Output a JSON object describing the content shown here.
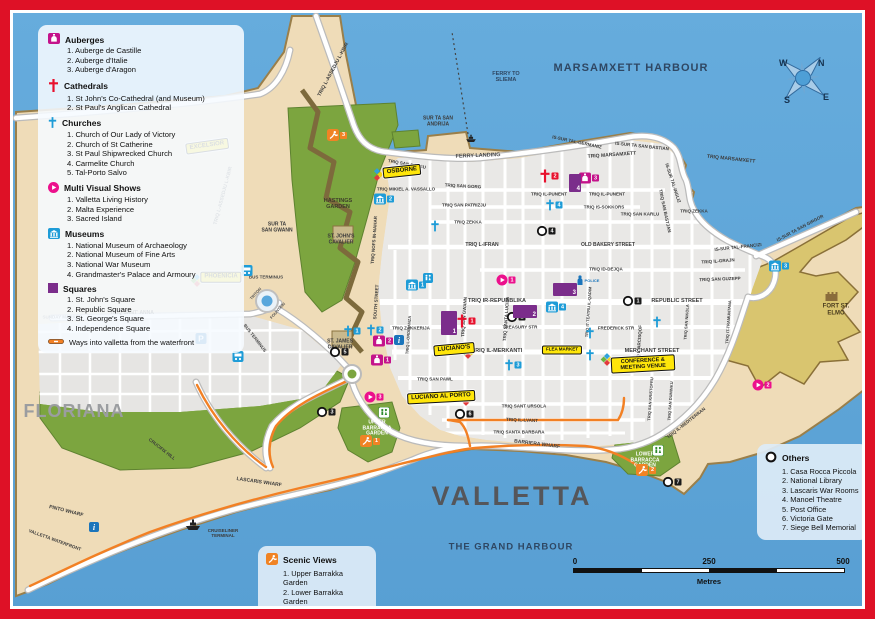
{
  "labels": {
    "city": "VALLETTA",
    "district": "FLORIANA",
    "harbour_top": "MARSAMXETT HARBOUR",
    "harbour_bottom": "THE GRAND HARBOUR",
    "fort": "FORT ST. ELMO"
  },
  "legend_main": {
    "sections": [
      {
        "key": "auberge",
        "title": "Auberges",
        "icon": "auberge-icon",
        "color": "#C4138B",
        "items": [
          "Auberge de Castille",
          "Auberge d'Italie",
          "Auberge d'Aragon"
        ]
      },
      {
        "key": "cathedral",
        "title": "Cathedrals",
        "icon": "cathedral-cross-icon",
        "color": "#E8112D",
        "items": [
          "St John's Co-Cathedral (and Museum)",
          "St Paul's Anglican Cathedral"
        ]
      },
      {
        "key": "church",
        "title": "Churches",
        "icon": "church-cross-icon",
        "color": "#1E9CD7",
        "items": [
          "Church of Our Lady of Victory",
          "Church of St Catherine",
          "St Paul Shipwrecked Church",
          "Carmelite Church",
          "Tal-Porto Salvo"
        ]
      },
      {
        "key": "show",
        "title": "Multi Visual Shows",
        "icon": "play-icon",
        "color": "#EC108C",
        "items": [
          "Valletta Living History",
          "Malta Experience",
          "Sacred Island"
        ]
      },
      {
        "key": "museum",
        "title": "Museums",
        "icon": "museum-icon",
        "color": "#1E9CD7",
        "items": [
          "National Museum of Archaeology",
          "National Museum of Fine Arts",
          "National War Museum",
          "Grandmaster's Palace and Armoury"
        ]
      },
      {
        "key": "square",
        "title": "Squares",
        "icon": "square-icon",
        "color": "#7B2D8B",
        "items": [
          "St. John's Square",
          "Republic Square",
          "St. George's Square",
          "Independence Square"
        ]
      }
    ],
    "ways_note": "Ways into valletta from the waterfront",
    "ways_color": "#F08324"
  },
  "legend_others": {
    "title": "Others",
    "color": "#1A1A1A",
    "items": [
      "Casa Rocca Piccola",
      "National Library",
      "Lascaris War Rooms",
      "Manoel Theatre",
      "Post Office",
      "Victoria Gate",
      "Siege Bell Memorial"
    ]
  },
  "legend_scenic": {
    "title": "Scenic Views",
    "color": "#F08324",
    "items": [
      "Upper Barrakka Garden",
      "Lower Barrakka Garden",
      "Hastings Garden"
    ]
  },
  "compass": {
    "points": [
      "N",
      "E",
      "S",
      "W"
    ]
  },
  "scale_bar": {
    "ticks": [
      "0",
      "250",
      "500"
    ],
    "unit": "Metres"
  },
  "yellow_labels": [
    {
      "text": "EXCELSIOR",
      "x": 207,
      "y": 146,
      "r": -8
    },
    {
      "text": "OSBORNE",
      "x": 402,
      "y": 171,
      "r": -6
    },
    {
      "text": "PHOENICIA",
      "x": 221,
      "y": 277,
      "r": 0
    },
    {
      "text": "LUCIANO'S",
      "x": 454,
      "y": 349,
      "r": -5
    },
    {
      "text": "LUCIANO AL PORTO",
      "x": 441,
      "y": 397,
      "r": -3
    },
    {
      "text": "CONFERENCE & MEETING VENUE",
      "x": 643,
      "y": 364,
      "r": -3,
      "w": 64,
      "s": 5.5
    },
    {
      "text": "FLEA MARKET",
      "x": 562,
      "y": 350,
      "r": 0,
      "s": 4.5
    }
  ],
  "street_labels": [
    {
      "t": "MARSAMXETT HARBOUR",
      "x": 631,
      "y": 68,
      "s": 11,
      "c": "#2F4763",
      "sp": 1
    },
    {
      "t": "THE GRAND HARBOUR",
      "x": 511,
      "y": 548,
      "s": 9.5,
      "c": "#2F4763",
      "sp": 1
    },
    {
      "t": "VALLETTA",
      "x": 512,
      "y": 496,
      "s": 27,
      "c": "#55565A",
      "sp": 3
    },
    {
      "t": "FLORIANA",
      "x": 74,
      "y": 411,
      "s": 18,
      "c": "#9B9DA0",
      "sp": 1
    },
    {
      "t": "FORT ST. ELMO",
      "x": 836,
      "y": 310,
      "s": 6,
      "c": "#4a3c1e"
    },
    {
      "t": "FERRY TO\nSLIEMA",
      "x": 506,
      "y": 77,
      "s": 5.5,
      "c": "#2F4763"
    },
    {
      "t": "FERRY LANDING",
      "x": 478,
      "y": 156,
      "s": 5.5,
      "c": "#4a4a4a",
      "r": -2
    },
    {
      "t": "SUR TA SAN\nANDRIJA",
      "x": 438,
      "y": 122,
      "s": 5
    },
    {
      "t": "HASTINGS\nGARDEN",
      "x": 338,
      "y": 204,
      "s": 5.5,
      "c": "#3d3d2a"
    },
    {
      "t": "ST. JOHN'S\nCAVALIER",
      "x": 341,
      "y": 240,
      "s": 5
    },
    {
      "t": "SUR TA\nSAN GWANN",
      "x": 277,
      "y": 228,
      "s": 5
    },
    {
      "t": "ST. JAMES\nCAVALIER",
      "x": 340,
      "y": 345,
      "s": 5
    },
    {
      "t": "UPPER\nBARRACCA\nGARDEN",
      "x": 377,
      "y": 429,
      "s": 5,
      "c": "#ffffff"
    },
    {
      "t": "LOWER\nBARRACCA\nGARDEN",
      "x": 645,
      "y": 461,
      "s": 5,
      "c": "#ffffff"
    },
    {
      "t": "TRIQ L-ASSEDJU L-KBIR",
      "x": 334,
      "y": 70,
      "r": -62,
      "s": 5
    },
    {
      "t": "TRIQ L-ASSEDJU L-KBIR",
      "x": 224,
      "y": 196,
      "r": -75,
      "s": 5
    },
    {
      "t": "IS-SUR TAL-GERMANIZ",
      "x": 577,
      "y": 142,
      "r": 12,
      "s": 4.5
    },
    {
      "t": "IS-SUR TA SAN BASTIAN",
      "x": 642,
      "y": 146,
      "r": 6,
      "s": 4.5
    },
    {
      "t": "TRIQ MARSAMXETT",
      "x": 612,
      "y": 156,
      "r": -4,
      "s": 5
    },
    {
      "t": "TRIQ MARSAMXETT",
      "x": 731,
      "y": 160,
      "r": 6,
      "s": 5
    },
    {
      "t": "TRIQ SAN BJAGU",
      "x": 407,
      "y": 164,
      "r": 10,
      "s": 4.5
    },
    {
      "t": "TRIQ MIKIEL A. VASSALLO",
      "x": 406,
      "y": 189,
      "s": 4.5
    },
    {
      "t": "TRIQ SAN GORG",
      "x": 463,
      "y": 186,
      "r": 3,
      "s": 4.5
    },
    {
      "t": "TRIQ SAN PATRIZJU",
      "x": 464,
      "y": 205,
      "s": 4.5
    },
    {
      "t": "TRIQ ZEKKA",
      "x": 468,
      "y": 222,
      "s": 4.5
    },
    {
      "t": "TRIQ ZEKKA",
      "x": 694,
      "y": 211,
      "s": 4.5
    },
    {
      "t": "TRIQ IL-PUNENT",
      "x": 549,
      "y": 194,
      "s": 4.5
    },
    {
      "t": "TRIQ IL-PUNENT",
      "x": 607,
      "y": 194,
      "s": 4.5
    },
    {
      "t": "TRIQ IS-SOKKORS",
      "x": 604,
      "y": 207,
      "s": 4.5
    },
    {
      "t": "TRIQ SAN KARLU",
      "x": 640,
      "y": 214,
      "s": 4.5
    },
    {
      "t": "TRIQ L-IFRAN",
      "x": 482,
      "y": 246,
      "s": 5
    },
    {
      "t": "OLD BAKERY STREET",
      "x": 608,
      "y": 246,
      "s": 5
    },
    {
      "t": "TRIQ ID-DEJQA",
      "x": 606,
      "y": 269,
      "s": 4.5
    },
    {
      "t": "TRIQ IR-REPUBBLIKA",
      "x": 497,
      "y": 301,
      "s": 5.5
    },
    {
      "t": "REPUBLIC STREET",
      "x": 677,
      "y": 301,
      "s": 5.5
    },
    {
      "t": "TRIQ ZAKKERIJA",
      "x": 411,
      "y": 328,
      "s": 4.5
    },
    {
      "t": "TREASURY STR",
      "x": 520,
      "y": 327,
      "s": 4.5
    },
    {
      "t": "FREDERICK STR",
      "x": 616,
      "y": 328,
      "s": 4.5
    },
    {
      "t": "TRIQ IL-MERKANTI",
      "x": 497,
      "y": 351,
      "s": 5.5
    },
    {
      "t": "MERCHANT STREET",
      "x": 652,
      "y": 351,
      "s": 5.5
    },
    {
      "t": "TRIQ SAN PAWL",
      "x": 435,
      "y": 379,
      "s": 4.5
    },
    {
      "t": "TRIQ SANT URSOLA",
      "x": 524,
      "y": 406,
      "s": 4.5
    },
    {
      "t": "TRIQ SANTA BARBARA",
      "x": 519,
      "y": 432,
      "s": 4.5
    },
    {
      "t": "BARRIERA WHARF",
      "x": 537,
      "y": 445,
      "r": 7,
      "s": 5
    },
    {
      "t": "TRIQ SANT' ANNA",
      "x": 132,
      "y": 314,
      "s": 5
    },
    {
      "t": "SUNDAY MARKET",
      "x": 62,
      "y": 317,
      "s": 4.5,
      "c": "#666666"
    },
    {
      "t": "CRUCIFIX HILL",
      "x": 162,
      "y": 449,
      "r": 38,
      "s": 4.5
    },
    {
      "t": "LASCARIS WHARF",
      "x": 259,
      "y": 483,
      "r": 8,
      "s": 5
    },
    {
      "t": "PINTO WHARF",
      "x": 66,
      "y": 512,
      "r": 14,
      "s": 5
    },
    {
      "t": "VALLETTA WATERFRONT",
      "x": 55,
      "y": 540,
      "r": 20,
      "s": 4.5
    },
    {
      "t": "CRUISELINER\nTERMINAL",
      "x": 223,
      "y": 533,
      "s": 4.5
    },
    {
      "t": "IS-SUR TAL-INGLIZ",
      "x": 673,
      "y": 183,
      "r": 72,
      "s": 4.5
    },
    {
      "t": "TRIQ SAN BASTJAN",
      "x": 665,
      "y": 211,
      "r": 78,
      "s": 4.5
    },
    {
      "t": "IS-SUR TA SAN GIRGOR",
      "x": 800,
      "y": 228,
      "r": -28,
      "s": 4.5
    },
    {
      "t": "IS-SUR TAL-FRANCIZI",
      "x": 738,
      "y": 247,
      "r": -6,
      "s": 4.5
    },
    {
      "t": "TRIQ IL-GRAJN",
      "x": 718,
      "y": 261,
      "r": -4,
      "s": 4.5
    },
    {
      "t": "TRIQ SAN GUZEPP",
      "x": 720,
      "y": 279,
      "r": -2,
      "s": 4.5
    },
    {
      "t": "TRIQ IL-LVANT",
      "x": 522,
      "y": 420,
      "r": 2,
      "s": 4.5
    },
    {
      "t": "TRIQ NOFS IN-NAHAR",
      "x": 374,
      "y": 240,
      "r": -86,
      "s": 4.5
    },
    {
      "t": "SOUTH STREET",
      "x": 376,
      "y": 302,
      "r": -86,
      "s": 4.5
    },
    {
      "t": "TRIQ L-ORDINANZA",
      "x": 409,
      "y": 335,
      "r": -86,
      "s": 4
    },
    {
      "t": "TRIQ SAN GWANN",
      "x": 464,
      "y": 317,
      "r": -86,
      "s": 4.5
    },
    {
      "t": "TRIQ SANTA LUCIJA",
      "x": 506,
      "y": 319,
      "r": -86,
      "s": 4.5
    },
    {
      "t": "TRIQ IT-TEATRU IL-QADIM",
      "x": 589,
      "y": 312,
      "r": -86,
      "s": 4
    },
    {
      "t": "TRIQ L-ARCISQOF",
      "x": 639,
      "y": 345,
      "r": -86,
      "s": 4.5
    },
    {
      "t": "TRIQ SAN KRISTOFRU",
      "x": 651,
      "y": 399,
      "r": -86,
      "s": 4
    },
    {
      "t": "TRIQ SAN DUMINKU",
      "x": 671,
      "y": 401,
      "r": -86,
      "s": 4
    },
    {
      "t": "TRIQ SAN NIKOLA",
      "x": 687,
      "y": 322,
      "r": -86,
      "s": 4
    },
    {
      "t": "TRIQ IT-TRAMUNTANA",
      "x": 729,
      "y": 322,
      "r": -86,
      "s": 4
    },
    {
      "t": "TRIQ IL-MEDITERRAN",
      "x": 686,
      "y": 423,
      "r": -38,
      "s": 4.5
    },
    {
      "t": "BUS TERMINUS",
      "x": 266,
      "y": 277,
      "s": 4.5,
      "c": "#4a4a4a"
    },
    {
      "t": "BUS TERMINUS",
      "x": 255,
      "y": 338,
      "r": 52,
      "s": 4.5,
      "c": "#4a4a4a"
    },
    {
      "t": "TRITON",
      "x": 256,
      "y": 294,
      "r": -48,
      "s": 4,
      "c": "#555555"
    },
    {
      "t": "FOUNTAIN",
      "x": 278,
      "y": 311,
      "r": -48,
      "s": 4,
      "c": "#555555"
    },
    {
      "t": "POLICE",
      "x": 592,
      "y": 281,
      "s": 4,
      "c": "#1B75BB"
    }
  ],
  "markers": [
    {
      "type": "auberge",
      "n": "1",
      "x": 381,
      "y": 360
    },
    {
      "type": "auberge",
      "n": "2",
      "x": 383,
      "y": 341
    },
    {
      "type": "auberge",
      "n": "3",
      "x": 589,
      "y": 178
    },
    {
      "type": "cathedral",
      "n": "1",
      "x": 466,
      "y": 321
    },
    {
      "type": "cathedral",
      "n": "2",
      "x": 549,
      "y": 176
    },
    {
      "type": "church",
      "n": "1",
      "x": 352,
      "y": 331
    },
    {
      "type": "church",
      "n": "2",
      "x": 375,
      "y": 330
    },
    {
      "type": "church",
      "n": "3",
      "x": 513,
      "y": 365
    },
    {
      "type": "church",
      "n": "4",
      "x": 554,
      "y": 205
    },
    {
      "type": "church",
      "n": "5",
      "x": 661,
      "y": 363
    },
    {
      "type": "church",
      "n": "",
      "x": 435,
      "y": 226
    },
    {
      "type": "church",
      "n": "",
      "x": 657,
      "y": 322
    },
    {
      "type": "church",
      "n": "",
      "x": 590,
      "y": 333
    },
    {
      "type": "church",
      "n": "",
      "x": 590,
      "y": 355
    },
    {
      "type": "show",
      "n": "1",
      "x": 506,
      "y": 280
    },
    {
      "type": "show",
      "n": "2",
      "x": 762,
      "y": 385
    },
    {
      "type": "show",
      "n": "3",
      "x": 374,
      "y": 397
    },
    {
      "type": "museum",
      "n": "1",
      "x": 416,
      "y": 285
    },
    {
      "type": "museum",
      "n": "2",
      "x": 384,
      "y": 199
    },
    {
      "type": "museum",
      "n": "3",
      "x": 779,
      "y": 266
    },
    {
      "type": "museum",
      "n": "4",
      "x": 556,
      "y": 307
    },
    {
      "type": "other",
      "n": "1",
      "x": 632,
      "y": 301
    },
    {
      "type": "other",
      "n": "2",
      "x": 516,
      "y": 317
    },
    {
      "type": "other",
      "n": "3",
      "x": 326,
      "y": 412
    },
    {
      "type": "other",
      "n": "4",
      "x": 546,
      "y": 231
    },
    {
      "type": "other",
      "n": "5",
      "x": 339,
      "y": 352
    },
    {
      "type": "other",
      "n": "6",
      "x": 464,
      "y": 414
    },
    {
      "type": "other",
      "n": "7",
      "x": 672,
      "y": 482
    },
    {
      "type": "scenic",
      "n": "1",
      "x": 370,
      "y": 441
    },
    {
      "type": "scenic",
      "n": "2",
      "x": 646,
      "y": 470
    },
    {
      "type": "scenic",
      "n": "3",
      "x": 337,
      "y": 135
    }
  ],
  "square_markers": [
    {
      "n": "1",
      "x": 441,
      "y": 311,
      "w": 16,
      "h": 24
    },
    {
      "n": "2",
      "x": 513,
      "y": 305,
      "w": 24,
      "h": 13
    },
    {
      "n": "3",
      "x": 553,
      "y": 283,
      "w": 24,
      "h": 13
    },
    {
      "n": "4",
      "x": 569,
      "y": 174,
      "w": 12,
      "h": 18
    }
  ],
  "poi_icons": [
    {
      "type": "hotel",
      "x": 193,
      "y": 151
    },
    {
      "type": "hotel",
      "x": 377,
      "y": 177
    },
    {
      "type": "hotel",
      "x": 197,
      "y": 283
    },
    {
      "type": "hotel",
      "x": 468,
      "y": 355
    },
    {
      "type": "hotel",
      "x": 466,
      "y": 402
    },
    {
      "type": "hotel",
      "x": 607,
      "y": 362
    },
    {
      "type": "bus",
      "x": 247,
      "y": 272
    },
    {
      "type": "bus",
      "x": 238,
      "y": 358
    },
    {
      "type": "wc-green",
      "x": 384,
      "y": 414
    },
    {
      "type": "wc-green",
      "x": 658,
      "y": 452
    },
    {
      "type": "wc-blue",
      "x": 428,
      "y": 279
    },
    {
      "type": "info",
      "x": 399,
      "y": 341
    },
    {
      "type": "info",
      "x": 94,
      "y": 528
    },
    {
      "type": "parking",
      "x": 201,
      "y": 340
    },
    {
      "type": "ship",
      "x": 193,
      "y": 527
    },
    {
      "type": "ferry-boat",
      "x": 471,
      "y": 139
    },
    {
      "type": "castle",
      "x": 831,
      "y": 297
    },
    {
      "type": "police",
      "x": 580,
      "y": 281
    }
  ]
}
